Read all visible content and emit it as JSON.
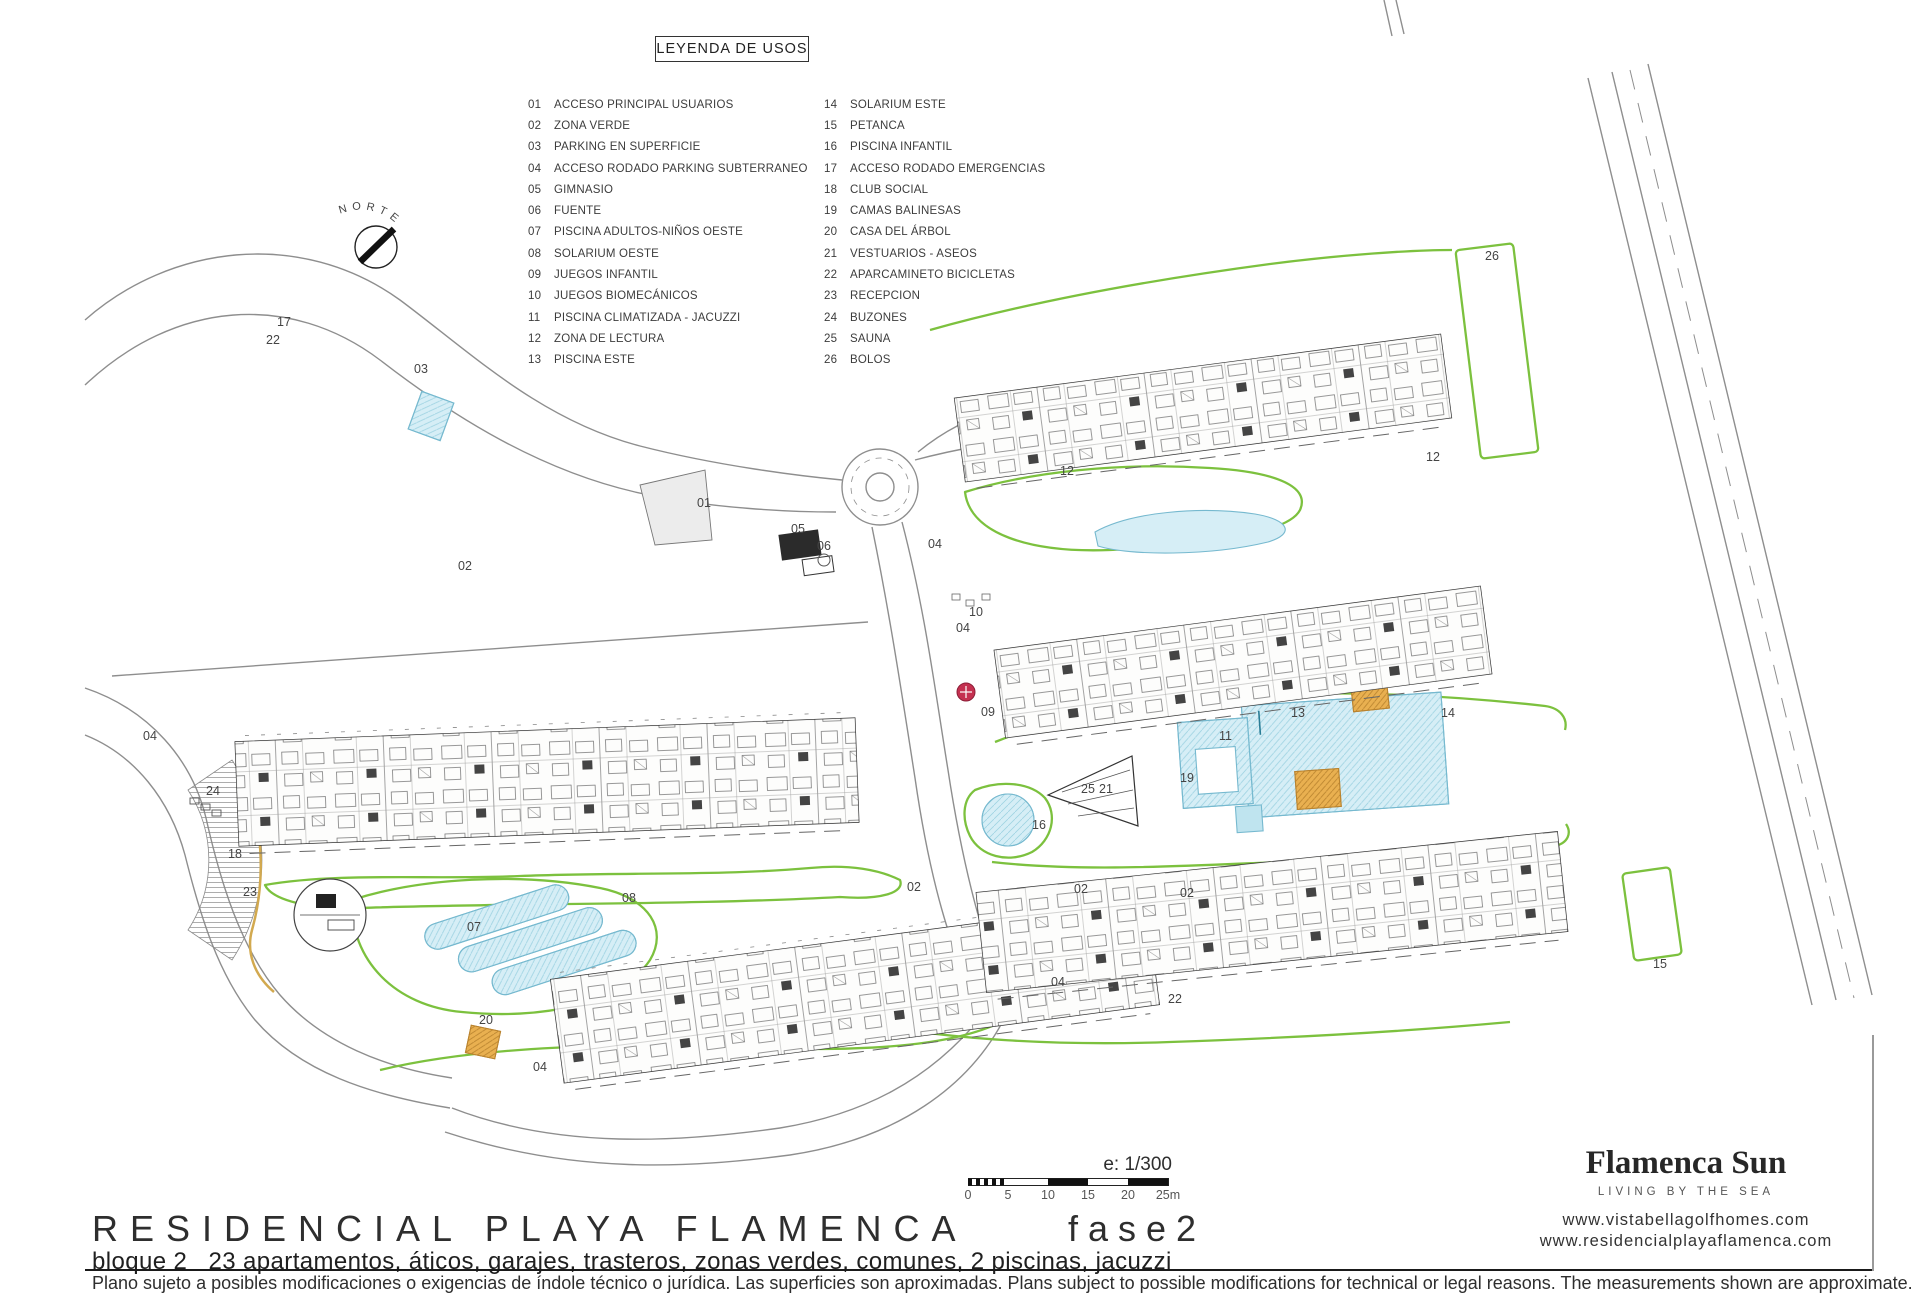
{
  "legend": {
    "title": "LEYENDA DE USOS",
    "items_col1": [
      {
        "num": "01",
        "label": "ACCESO PRINCIPAL USUARIOS"
      },
      {
        "num": "02",
        "label": "ZONA VERDE"
      },
      {
        "num": "03",
        "label": "PARKING EN SUPERFICIE"
      },
      {
        "num": "04",
        "label": "ACCESO RODADO PARKING SUBTERRANEO"
      },
      {
        "num": "05",
        "label": "GIMNASIO"
      },
      {
        "num": "06",
        "label": "FUENTE"
      },
      {
        "num": "07",
        "label": "PISCINA ADULTOS-NIÑOS OESTE"
      },
      {
        "num": "08",
        "label": "SOLARIUM OESTE"
      },
      {
        "num": "09",
        "label": "JUEGOS INFANTIL"
      },
      {
        "num": "10",
        "label": "JUEGOS BIOMECÁNICOS"
      },
      {
        "num": "11",
        "label": "PISCINA CLIMATIZADA - JACUZZI"
      },
      {
        "num": "12",
        "label": "ZONA DE LECTURA"
      },
      {
        "num": "13",
        "label": "PISCINA ESTE"
      }
    ],
    "items_col2": [
      {
        "num": "14",
        "label": "SOLARIUM ESTE"
      },
      {
        "num": "15",
        "label": "PETANCA"
      },
      {
        "num": "16",
        "label": "PISCINA INFANTIL"
      },
      {
        "num": "17",
        "label": "ACCESO RODADO EMERGENCIAS"
      },
      {
        "num": "18",
        "label": "CLUB SOCIAL"
      },
      {
        "num": "19",
        "label": "CAMAS BALINESAS"
      },
      {
        "num": "20",
        "label": "CASA DEL ÁRBOL"
      },
      {
        "num": "21",
        "label": "VESTUARIOS - ASEOS"
      },
      {
        "num": "22",
        "label": "APARCAMINETO BICICLETAS"
      },
      {
        "num": "23",
        "label": "RECEPCION"
      },
      {
        "num": "24",
        "label": "BUZONES"
      },
      {
        "num": "25",
        "label": "SAUNA"
      },
      {
        "num": "26",
        "label": "BOLOS"
      }
    ]
  },
  "plan": {
    "north_label": "NORTE",
    "block_labels": [
      {
        "text": "Bloque n°.1",
        "x": 287,
        "y": 860
      },
      {
        "text": "Bloque n°.2",
        "x": 690,
        "y": 1078
      },
      {
        "text": "Bloque n°.3",
        "x": 1588,
        "y": 852
      },
      {
        "text": "Bloque n°.4",
        "x": 1485,
        "y": 546
      },
      {
        "text": "Bloque n°.5",
        "x": 1435,
        "y": 331
      }
    ],
    "number_labels": [
      {
        "n": "17",
        "x": 277,
        "y": 326
      },
      {
        "n": "22",
        "x": 266,
        "y": 344
      },
      {
        "n": "03",
        "x": 414,
        "y": 373
      },
      {
        "n": "02",
        "x": 458,
        "y": 570
      },
      {
        "n": "01",
        "x": 697,
        "y": 507
      },
      {
        "n": "05",
        "x": 791,
        "y": 533
      },
      {
        "n": "06",
        "x": 817,
        "y": 550
      },
      {
        "n": "04",
        "x": 928,
        "y": 548
      },
      {
        "n": "12",
        "x": 1060,
        "y": 475
      },
      {
        "n": "12",
        "x": 1426,
        "y": 461
      },
      {
        "n": "10",
        "x": 969,
        "y": 616
      },
      {
        "n": "04",
        "x": 956,
        "y": 632
      },
      {
        "n": "09",
        "x": 981,
        "y": 716
      },
      {
        "n": "02",
        "x": 907,
        "y": 891
      },
      {
        "n": "02",
        "x": 1074,
        "y": 893
      },
      {
        "n": "02",
        "x": 1180,
        "y": 897
      },
      {
        "n": "08",
        "x": 622,
        "y": 902
      },
      {
        "n": "07",
        "x": 467,
        "y": 931
      },
      {
        "n": "20",
        "x": 479,
        "y": 1024
      },
      {
        "n": "04",
        "x": 533,
        "y": 1071
      },
      {
        "n": "04",
        "x": 1051,
        "y": 986
      },
      {
        "n": "24",
        "x": 206,
        "y": 795
      },
      {
        "n": "18",
        "x": 228,
        "y": 858
      },
      {
        "n": "23",
        "x": 243,
        "y": 896
      },
      {
        "n": "16",
        "x": 1032,
        "y": 829
      },
      {
        "n": "19",
        "x": 1180,
        "y": 782
      },
      {
        "n": "25",
        "x": 1081,
        "y": 793
      },
      {
        "n": "21",
        "x": 1099,
        "y": 793
      },
      {
        "n": "11",
        "x": 1219,
        "y": 740
      },
      {
        "n": "13",
        "x": 1291,
        "y": 717
      },
      {
        "n": "14",
        "x": 1441,
        "y": 717
      },
      {
        "n": "15",
        "x": 1653,
        "y": 968
      },
      {
        "n": "26",
        "x": 1485,
        "y": 260
      },
      {
        "n": "22",
        "x": 1168,
        "y": 1003
      },
      {
        "n": "04",
        "x": 143,
        "y": 740
      }
    ]
  },
  "scalebar": {
    "scale_text": "e: 1/300",
    "ticks": [
      "0",
      "5",
      "10",
      "15",
      "20",
      "25m"
    ]
  },
  "titleblock": {
    "title": "RESIDENCIAL PLAYA FLAMENCA",
    "phase": "fase2",
    "subtitle": "bloque 2   23 apartamentos, áticos, garajes, trasteros, zonas verdes, comunes, 2 piscinas, jacuzzi",
    "disclaimer": "Plano sujeto a posibles modificaciones o exigencias de índole técnico o jurídica. Las superficies son aproximadas. Plans subject to possible modifications for technical or legal reasons. The measurements shown are approximate."
  },
  "logo": {
    "name": "Flamenca Sun",
    "tagline": "LIVING BY THE SEA",
    "url1": "www.vistabellagolfhomes.com",
    "url2": "www.residencialplayaflamenca.com",
    "petal_colors": [
      "#e5832a",
      "#1d9b93",
      "#54bfd9",
      "#2aa3ad",
      "#f2c42e",
      "#efa62b"
    ]
  },
  "colors": {
    "plan_green": "#7cc13e",
    "pool_fill": "#d6eef6",
    "pool_stroke": "#76b9cf",
    "tree_olive": "#cdc98e",
    "tan": "#e9b050"
  }
}
